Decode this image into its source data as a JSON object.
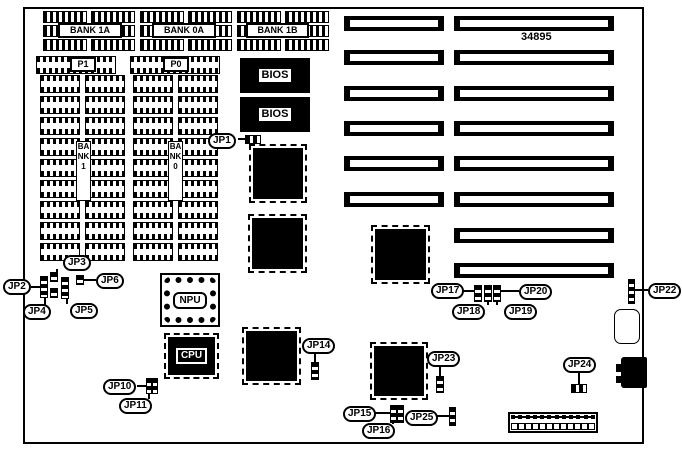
{
  "part_number": "34895",
  "memory": {
    "top_banks": [
      "BANK 1A",
      "BANK 0A",
      "BANK 1B"
    ],
    "row_connectors": [
      "P1",
      "P0"
    ],
    "vertical_banks": [
      "BANK 1",
      "BANK 0"
    ]
  },
  "chips": {
    "bios_top": "BIOS",
    "bios_bottom": "BIOS",
    "npu": "NPU",
    "cpu": "CPU"
  },
  "jumpers": {
    "jp1": "JP1",
    "jp2": "JP2",
    "jp3": "JP3",
    "jp4": "JP4",
    "jp5": "JP5",
    "jp6": "JP6",
    "jp10": "JP10",
    "jp11": "JP11",
    "jp14": "JP14",
    "jp15": "JP15",
    "jp16": "JP16",
    "jp17": "JP17",
    "jp18": "JP18",
    "jp19": "JP19",
    "jp20": "JP20",
    "jp22": "JP22",
    "jp23": "JP23",
    "jp24": "JP24",
    "jp25": "JP25"
  }
}
